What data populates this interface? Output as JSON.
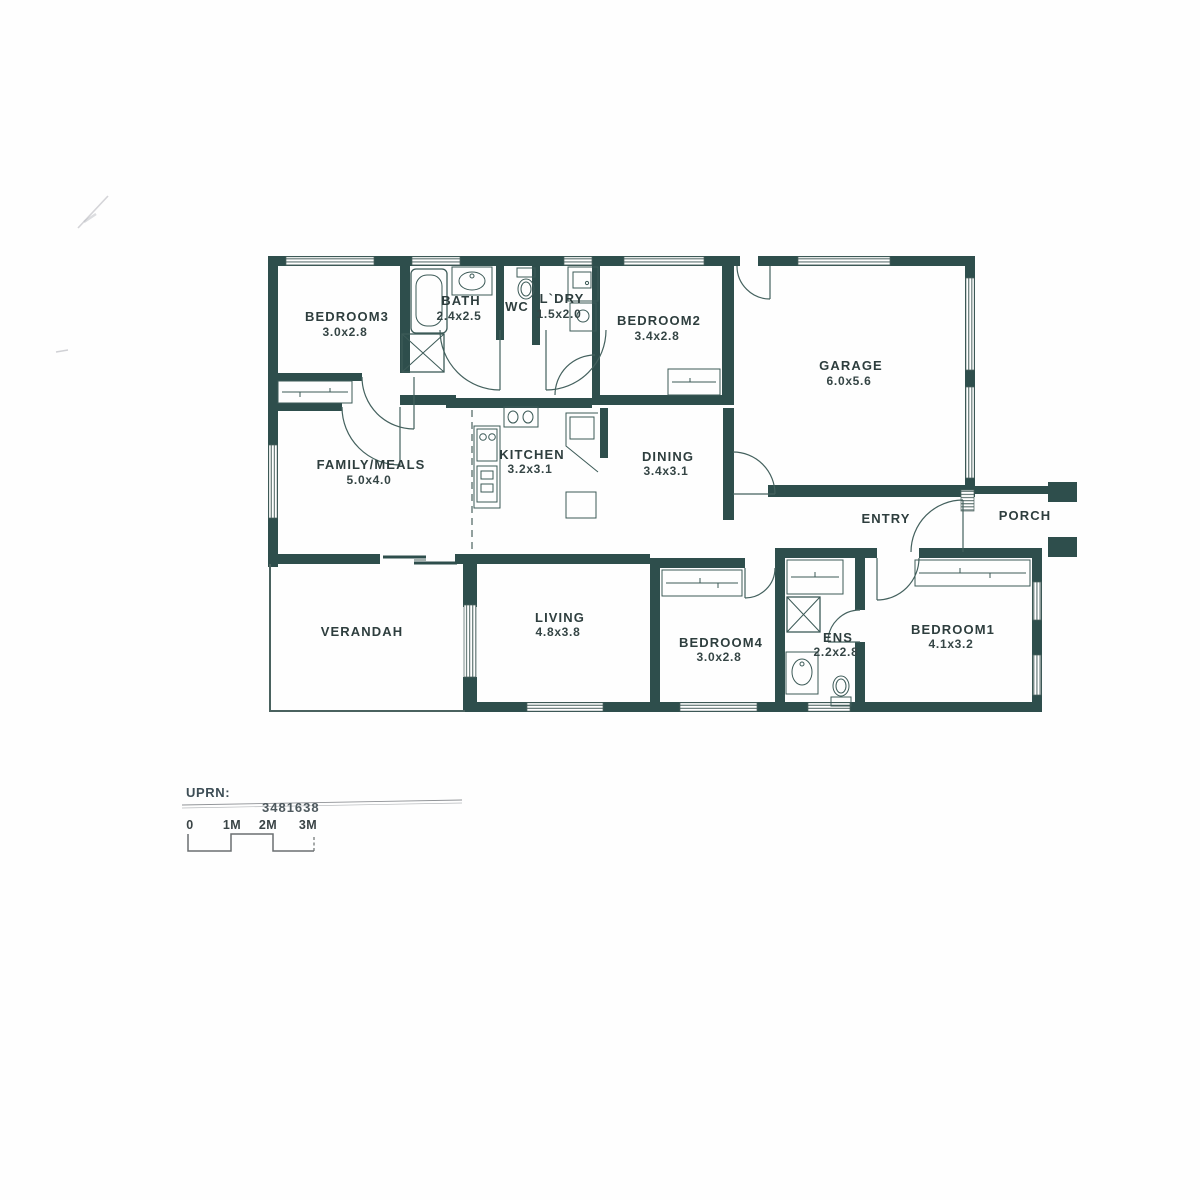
{
  "plan": {
    "wall_color": "#2e4e4c",
    "line_color": "#3c5a57",
    "rooms": {
      "bedroom3": {
        "name": "BEDROOM3",
        "dims": "3.0x2.8"
      },
      "bath": {
        "name": "BATH",
        "dims": "2.4x2.5"
      },
      "wc": {
        "name": "WC"
      },
      "ldry": {
        "name": "L`DRY",
        "dims": "1.5x2.0"
      },
      "bedroom2": {
        "name": "BEDROOM2",
        "dims": "3.4x2.8"
      },
      "garage": {
        "name": "GARAGE",
        "dims": "6.0x5.6"
      },
      "family": {
        "name": "FAMILY/MEALS",
        "dims": "5.0x4.0"
      },
      "kitchen": {
        "name": "KITCHEN",
        "dims": "3.2x3.1"
      },
      "dining": {
        "name": "DINING",
        "dims": "3.4x3.1"
      },
      "entry": {
        "name": "ENTRY"
      },
      "porch": {
        "name": "PORCH"
      },
      "verandah": {
        "name": "VERANDAH"
      },
      "living": {
        "name": "LIVING",
        "dims": "4.8x3.8"
      },
      "bedroom4": {
        "name": "BEDROOM4",
        "dims": "3.0x2.8"
      },
      "ens": {
        "name": "ENS",
        "dims": "2.2x2.8"
      },
      "bedroom1": {
        "name": "BEDROOM1",
        "dims": "4.1x3.2"
      }
    },
    "footer": {
      "uprn_label": "UPRN:",
      "uprn_value": "3481638",
      "scale_ticks": [
        "0",
        "1M",
        "2M",
        "3M"
      ]
    }
  }
}
